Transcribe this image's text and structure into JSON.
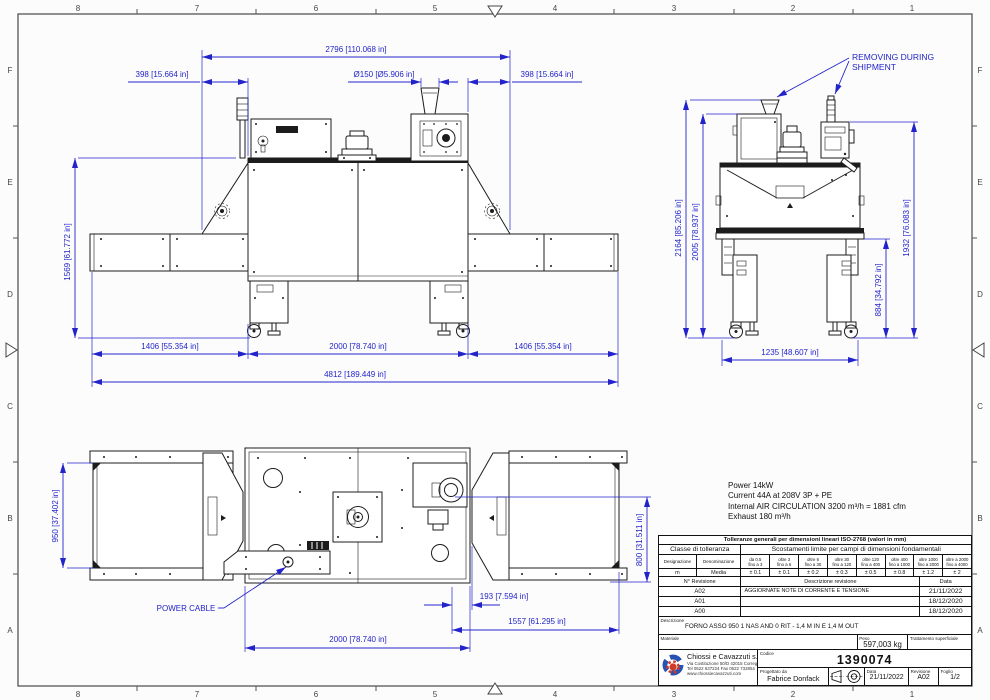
{
  "frame": {
    "cols": [
      "8",
      "7",
      "6",
      "5",
      "4",
      "3",
      "2",
      "1"
    ],
    "rows": [
      "F",
      "E",
      "D",
      "C",
      "B",
      "A"
    ]
  },
  "colors": {
    "dim_blue": "#2323cb",
    "line": "#1c1c1c",
    "logo_blue": "#2a52b0",
    "logo_red": "#cf3b2a"
  },
  "front_view": {
    "dim_width_top": "2796 [110.068 in]",
    "dim_offset_left": "398 [15.664 in]",
    "dim_offset_right": "398 [15.664 in]",
    "dim_chimney": "Ø150 [Ø5.906 in]",
    "dim_height": "1569 [61.772 in]",
    "dim_infeed": "1406 [55.354 in]",
    "dim_body": "2000 [78.740 in]",
    "dim_outfeed": "1406 [55.354 in]",
    "dim_overall": "4812 [189.449 in]"
  },
  "side_view": {
    "note_line1": "REMOVING DURING",
    "note_line2": "SHIPMENT",
    "dim_total_height": "2164 [85.206 in]",
    "dim_height_2": "2005 [78.937 in]",
    "dim_height_3": "1932 [76.083 in]",
    "dim_belt_height": "884 [34.792 in]",
    "dim_width": "1235 [48.607 in]"
  },
  "plan_view": {
    "label_power_cable": "POWER CABLE",
    "dim_conveyor_width": "950 [37.402 in]",
    "dim_belt_width": "800 [31.511 in]",
    "dim_offset": "193 [7.594 in]",
    "dim_outfeed": "1557 [61.295 in]",
    "dim_body": "2000 [78.740 in]"
  },
  "specs": {
    "line1": "Power 14kW",
    "line2": "Current 44A at 208V 3P + PE",
    "line3": "Internal AIR CIRCULATION 3200 m³/h = 1881 cfm",
    "line4": "Exhaust 180 m³/h"
  },
  "tolerance_table": {
    "title": "Tolleranze generali per dimensioni lineari ISO-2768 (valori in mm)",
    "class_header": "Classe di tolleranza",
    "limits_header": "Scostamenti limite per campi di dimensioni fondamentali",
    "designation_label": "Designazione",
    "denomination_label": "Denominazione",
    "ranges": [
      {
        "top": "da 0.5",
        "bot": "fino a 3"
      },
      {
        "top": "oltre 3",
        "bot": "fino a 6"
      },
      {
        "top": "oltre 6",
        "bot": "fino a 30"
      },
      {
        "top": "oltre 30",
        "bot": "fino a 120"
      },
      {
        "top": "oltre 120",
        "bot": "fino a 400"
      },
      {
        "top": "oltre 400",
        "bot": "fino a 1000"
      },
      {
        "top": "oltre 1000",
        "bot": "fino a 2000"
      },
      {
        "top": "oltre a 2000",
        "bot": "fino a 4000"
      }
    ],
    "designation": "m",
    "denomination": "Media",
    "values": [
      "± 0.1",
      "± 0.1",
      "± 0.2",
      "± 0.3",
      "± 0.5",
      "± 0.8",
      "± 1.2",
      "± 2"
    ]
  },
  "revisions": {
    "header_rev": "N° Revisione",
    "header_desc": "Descrizione revisione",
    "header_date": "Data",
    "rows": [
      {
        "rev": "A02",
        "desc": "AGGIORNATE NOTE DI CORRENTE E TENSIONE",
        "date": "21/11/2022"
      },
      {
        "rev": "A01",
        "desc": "",
        "date": "18/12/2020"
      },
      {
        "rev": "A00",
        "desc": "",
        "date": "18/12/2020"
      }
    ]
  },
  "title_block": {
    "description_label": "Descrizione",
    "description": "FORNO ASSO 950 1 NAS AND 0 RIT - 1,4 M IN E 1,4 M OUT",
    "material_label": "Materiale",
    "weight_label": "Peso",
    "weight": "597,003 kg",
    "treatment_label": "Trattamento superficiale",
    "company_name": "Chiossi e Cavazzuti s.r.l.",
    "company_address": "Via Costituzione 50/D 42015 Correggio RE",
    "company_phone": "Tel 0522 637224 Fax 0522 732854",
    "company_web": "www.chiossiecavazzuti.com",
    "code_label": "Codice",
    "code": "1390074",
    "designer_label": "Progettato da",
    "designer": "Fabrice Donfack",
    "date_label": "Data",
    "date": "21/11/2022",
    "revision_label": "Revisione",
    "revision": "A02",
    "sheet_label": "Foglio",
    "sheet": "1/2"
  }
}
